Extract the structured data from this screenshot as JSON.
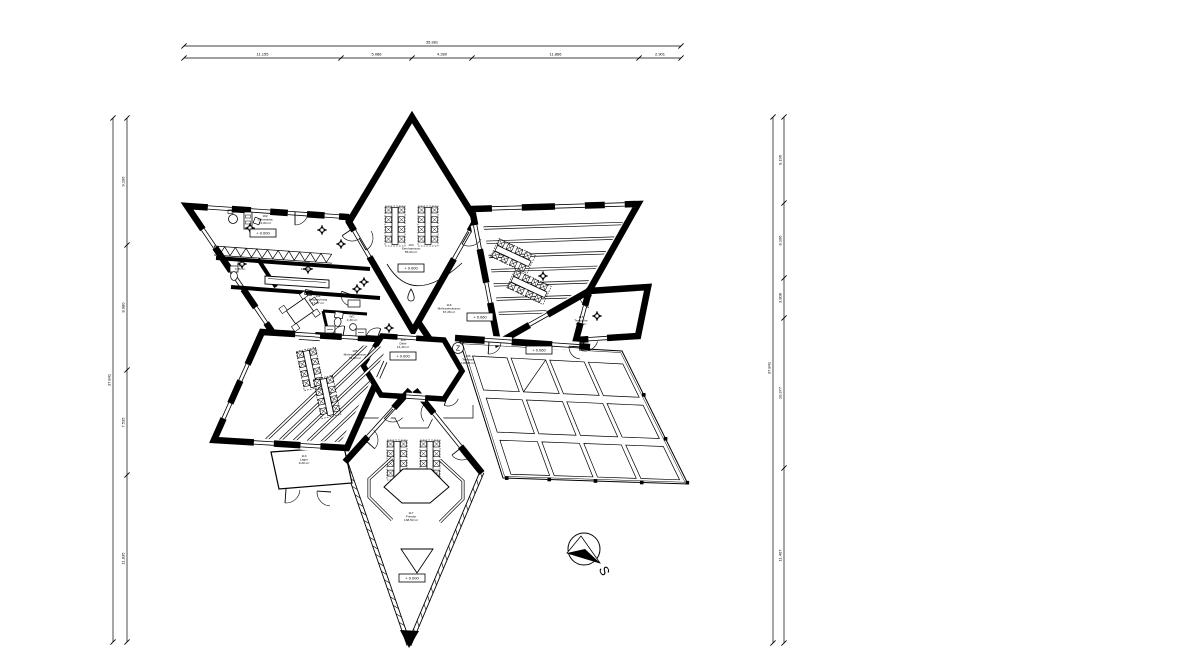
{
  "sheet": {
    "background": "#ffffff",
    "ink": "#000000"
  },
  "dimensions": {
    "top": {
      "total": "35.381",
      "segments": [
        "11.155",
        "5.086",
        "4.280",
        "11.866",
        "2.901"
      ]
    },
    "left": {
      "total": "37.841",
      "segments": [
        "9.196",
        "8.980",
        "7.535",
        "11.835"
      ]
    },
    "right": {
      "total": "37.841",
      "segments": [
        "9.196",
        "8.106",
        "3.808",
        "10.377",
        "11.407"
      ]
    }
  },
  "rooms": [
    {
      "id": "102",
      "name": "Sekretariat",
      "area": "21,84 m²",
      "elevation": "+ 0.000"
    },
    {
      "id": "101",
      "name": "WC",
      "area": "3,95 m²"
    },
    {
      "id": "108",
      "name": "Küche",
      "area": "10,80 m²"
    },
    {
      "id": "111",
      "name": "Besprechung",
      "area": "17,87 m²"
    },
    {
      "id": "109",
      "name": "WC",
      "area": "4,30 m²"
    },
    {
      "id": "104",
      "name": "Seminarraum",
      "area": "55,63 m²",
      "elevation": "+ 0.000"
    },
    {
      "id": "116",
      "name": "Mehrzweckraum",
      "area": "67,28 m²",
      "elevation": "+ 0.060"
    },
    {
      "id": "115",
      "name": "Teeküche",
      "area": "8,60 m²"
    },
    {
      "id": "110",
      "name": "Diele",
      "area": "14,40 m²",
      "elevation": "+ 0.000"
    },
    {
      "id": "105",
      "name": "Mehrzweckraum",
      "area": "94,84 m²"
    },
    {
      "id": "106",
      "name": "Terrasse",
      "area": "135,35 m²",
      "elevation": "+ 0.060"
    },
    {
      "id": "117",
      "name": "Freisitz",
      "area": "138,50 m²",
      "elevation": "+ 0.000"
    },
    {
      "id": "113",
      "name": "Lager",
      "area": "9,20 m²"
    }
  ],
  "markers": {
    "section": "Z",
    "compass": "S"
  }
}
